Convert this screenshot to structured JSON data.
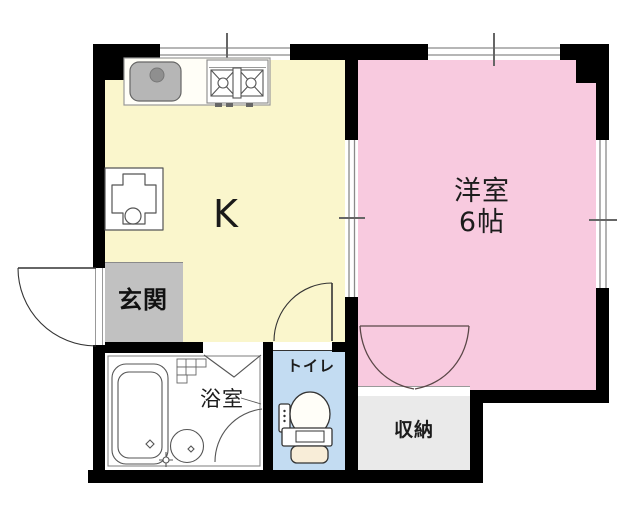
{
  "floor_plan": {
    "type": "apartment-1K-floorplan",
    "rooms": {
      "kitchen": {
        "label": "K",
        "floor_color": "#faf6cc"
      },
      "western_room": {
        "label": "洋室",
        "size": "6帖",
        "floor_color": "#f8cadf"
      },
      "entrance": {
        "label": "玄関",
        "floor_color": "#c1c1c1"
      },
      "bathroom": {
        "label": "浴室",
        "floor_color": "#ffffff"
      },
      "toilet": {
        "label": "トイレ",
        "floor_color": "#c3dcf2"
      },
      "storage": {
        "label": "収納",
        "floor_color": "#eaeaea"
      }
    },
    "colors": {
      "wall": "#000000",
      "background": "#ffffff",
      "fixture_line": "#555555",
      "sink_fill": "#b6b6b6",
      "toilet_seat_fill": "#f8edd8"
    },
    "fixtures": [
      "kitchen-counter",
      "sink",
      "two-burner-stove",
      "washing-machine-pan",
      "bathtub",
      "wash-basin",
      "faucet",
      "toilet-bowl",
      "entrance-door",
      "toilet-door",
      "bathroom-folding-door",
      "closet-double-doors",
      "windows"
    ]
  }
}
